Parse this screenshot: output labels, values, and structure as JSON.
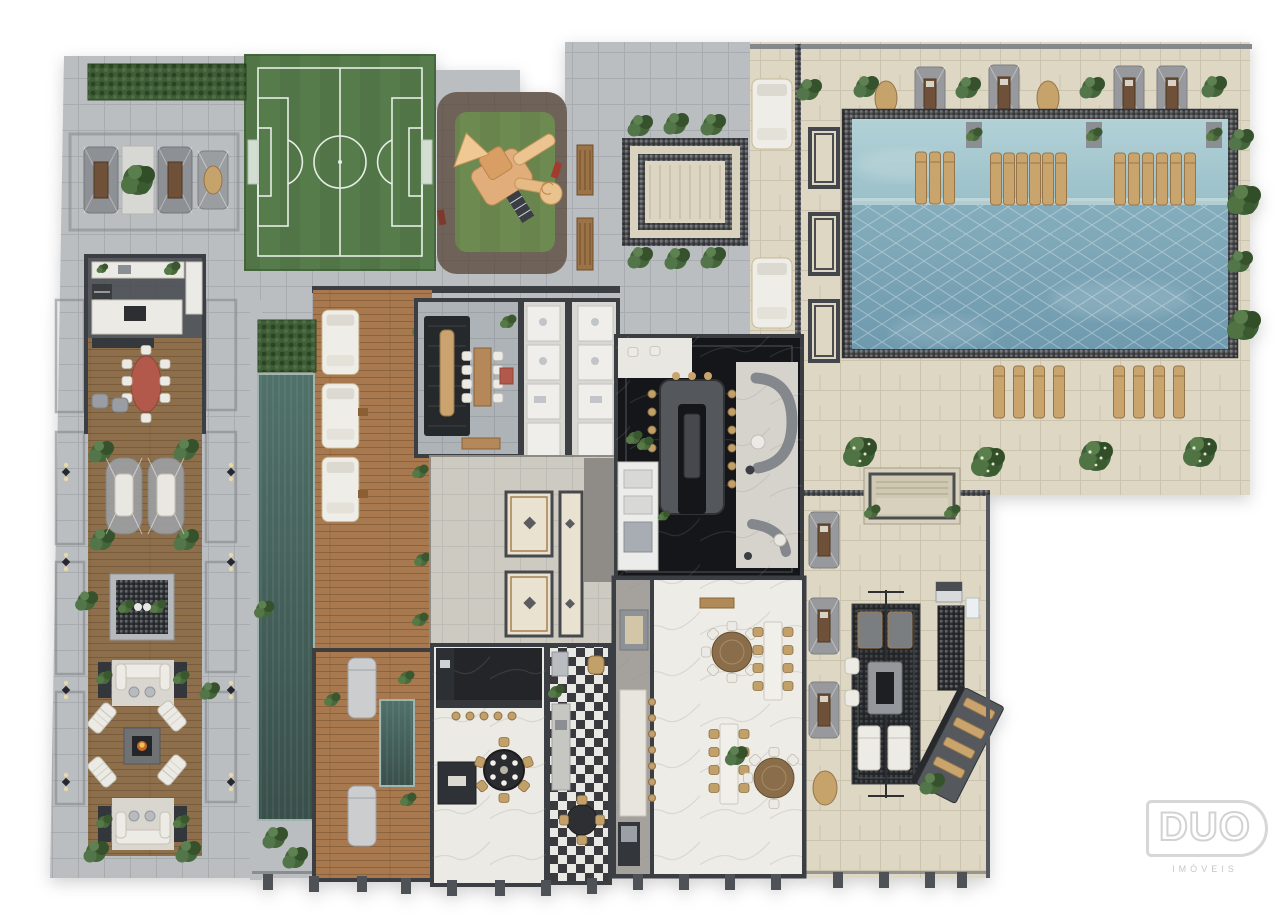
{
  "page": {
    "background": "#ffffff",
    "description": "Top-down 3D rendered implantation floor plan of a residential leisure deck"
  },
  "logo": {
    "title": "DUO",
    "subtitle": "IMÓVEIS"
  },
  "palette": {
    "bg": "#ffffff",
    "paver": "#babec1",
    "stone": "#ded7c3",
    "wall": "#3b3e42",
    "turf": "#577c4c",
    "grass": "#6d8a50",
    "playPaver": "#6f6258",
    "wood": "#a8794f",
    "woodDark": "#8d6f4c",
    "pool": "#7fa9b8",
    "poolLight": "#abcdd4",
    "lap": "#46635b",
    "marbleWhite": "#ebeae4",
    "marbleDark": "#141619",
    "tan": "#c6a26b",
    "red": "#b2594b",
    "plant": "#47643a",
    "hedge": "#3f5d36",
    "furnWhite": "#edebe5",
    "rug": "#26292c",
    "mosaic": "#4b4d50",
    "graniteGray": "#a5a29d",
    "lobbyFloor": "#cdcac2",
    "bathFloor": "#d8d7d2",
    "loungeFloor": "#aeb3b8",
    "checkerDark": "#27272b"
  },
  "plan": {
    "areas": [
      {
        "name": "left-plaza",
        "label": "Paved plaza with cabana loungers"
      },
      {
        "name": "bbq-gourmet-room",
        "label": "Barbecue gourmet room with oval dining table"
      },
      {
        "name": "swing-lounge",
        "label": "Hanging swing seats on timber deck"
      },
      {
        "name": "fountain-garden",
        "label": "Ornamental fountain planter"
      },
      {
        "name": "fire-pit-lounge",
        "label": "Fire pit lounge with chaises and sofas"
      },
      {
        "name": "soccer-field",
        "label": "Soccer field"
      },
      {
        "name": "playground",
        "label": "Playground with wooden play structure"
      },
      {
        "name": "central-plaza",
        "label": "Bench plaza with ornamental parterre"
      },
      {
        "name": "pool-terrace",
        "label": "Stone pool deck with cabanas and planters"
      },
      {
        "name": "swimming-pool",
        "label": "Swimming pool with in-water loungers"
      },
      {
        "name": "garden-steps",
        "label": "Landscaped terrace steps"
      },
      {
        "name": "lap-pool",
        "label": "Lap pool with hedge"
      },
      {
        "name": "sun-deck",
        "label": "Timber sun deck with daybeds"
      },
      {
        "name": "lounge-room",
        "label": "Lounge room with communal table and rug"
      },
      {
        "name": "restrooms",
        "label": "Restrooms and changing stalls"
      },
      {
        "name": "lobby",
        "label": "Lobby halls with ornamental rugs"
      },
      {
        "name": "bar-lounge",
        "label": "Dark marble bar lounge with U-shaped counter"
      },
      {
        "name": "spa-room",
        "label": "Spa with massage beds and plunge pool"
      },
      {
        "name": "gourmet-room",
        "label": "Gourmet room with round dining table"
      },
      {
        "name": "kitchen",
        "label": "Kitchen with checkered floor"
      },
      {
        "name": "party-hall",
        "label": "Party hall with round and long dining tables"
      },
      {
        "name": "terrace-cabanas",
        "label": "Terrace path with shade cabanas"
      },
      {
        "name": "pergola-lounge",
        "label": "Pergola outdoor living room with fire table"
      },
      {
        "name": "solarium",
        "label": "Sloped solarium deck with loungers"
      }
    ]
  }
}
